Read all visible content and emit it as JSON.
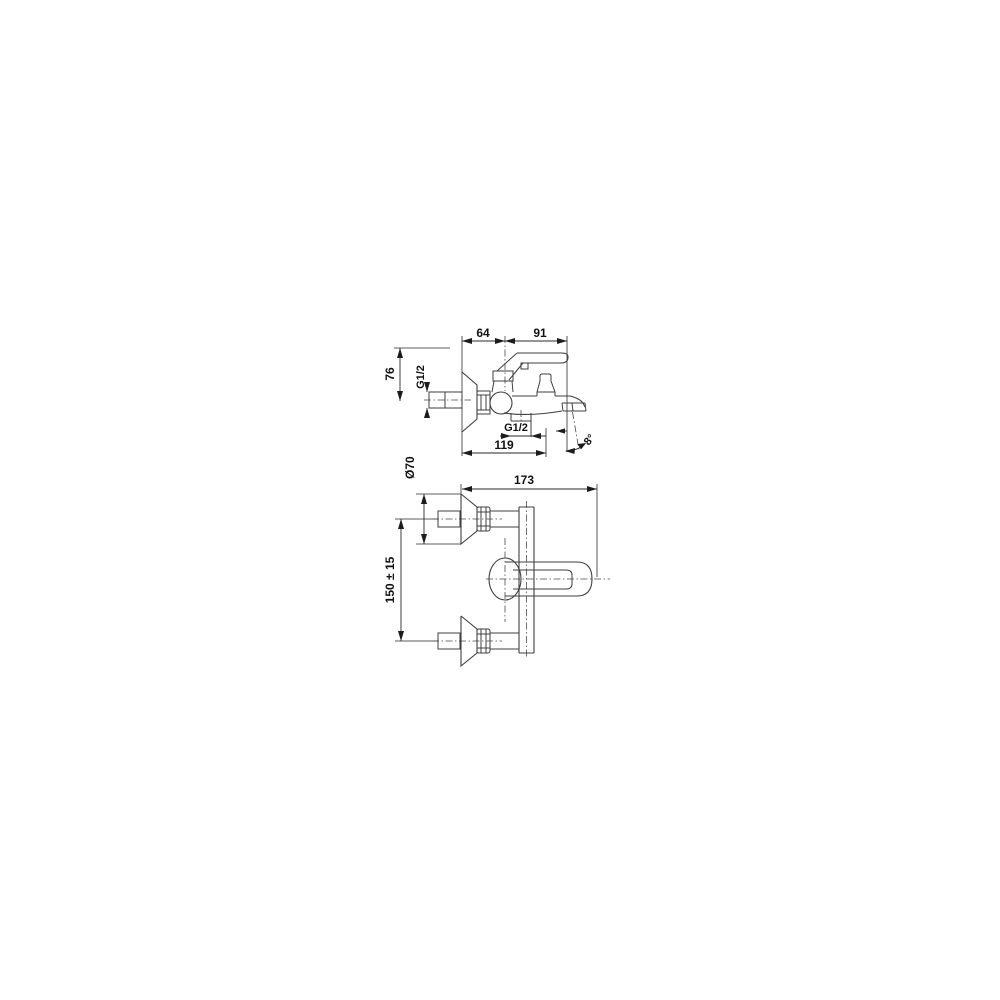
{
  "page": {
    "background_color": "#ffffff",
    "line_color": "#3f3f3f",
    "text_color": "#111111"
  },
  "drawing": {
    "side_view": {
      "dim_64": "64",
      "dim_91": "91",
      "dim_76": "76",
      "inlet_thread": "G1/2",
      "outlet_thread": "G1/2",
      "dim_119": "119",
      "spout_angle": "8°"
    },
    "plan_view": {
      "dim_diameter": "Ø70",
      "dim_173": "173",
      "dim_spacing": "150 ± 15"
    }
  }
}
